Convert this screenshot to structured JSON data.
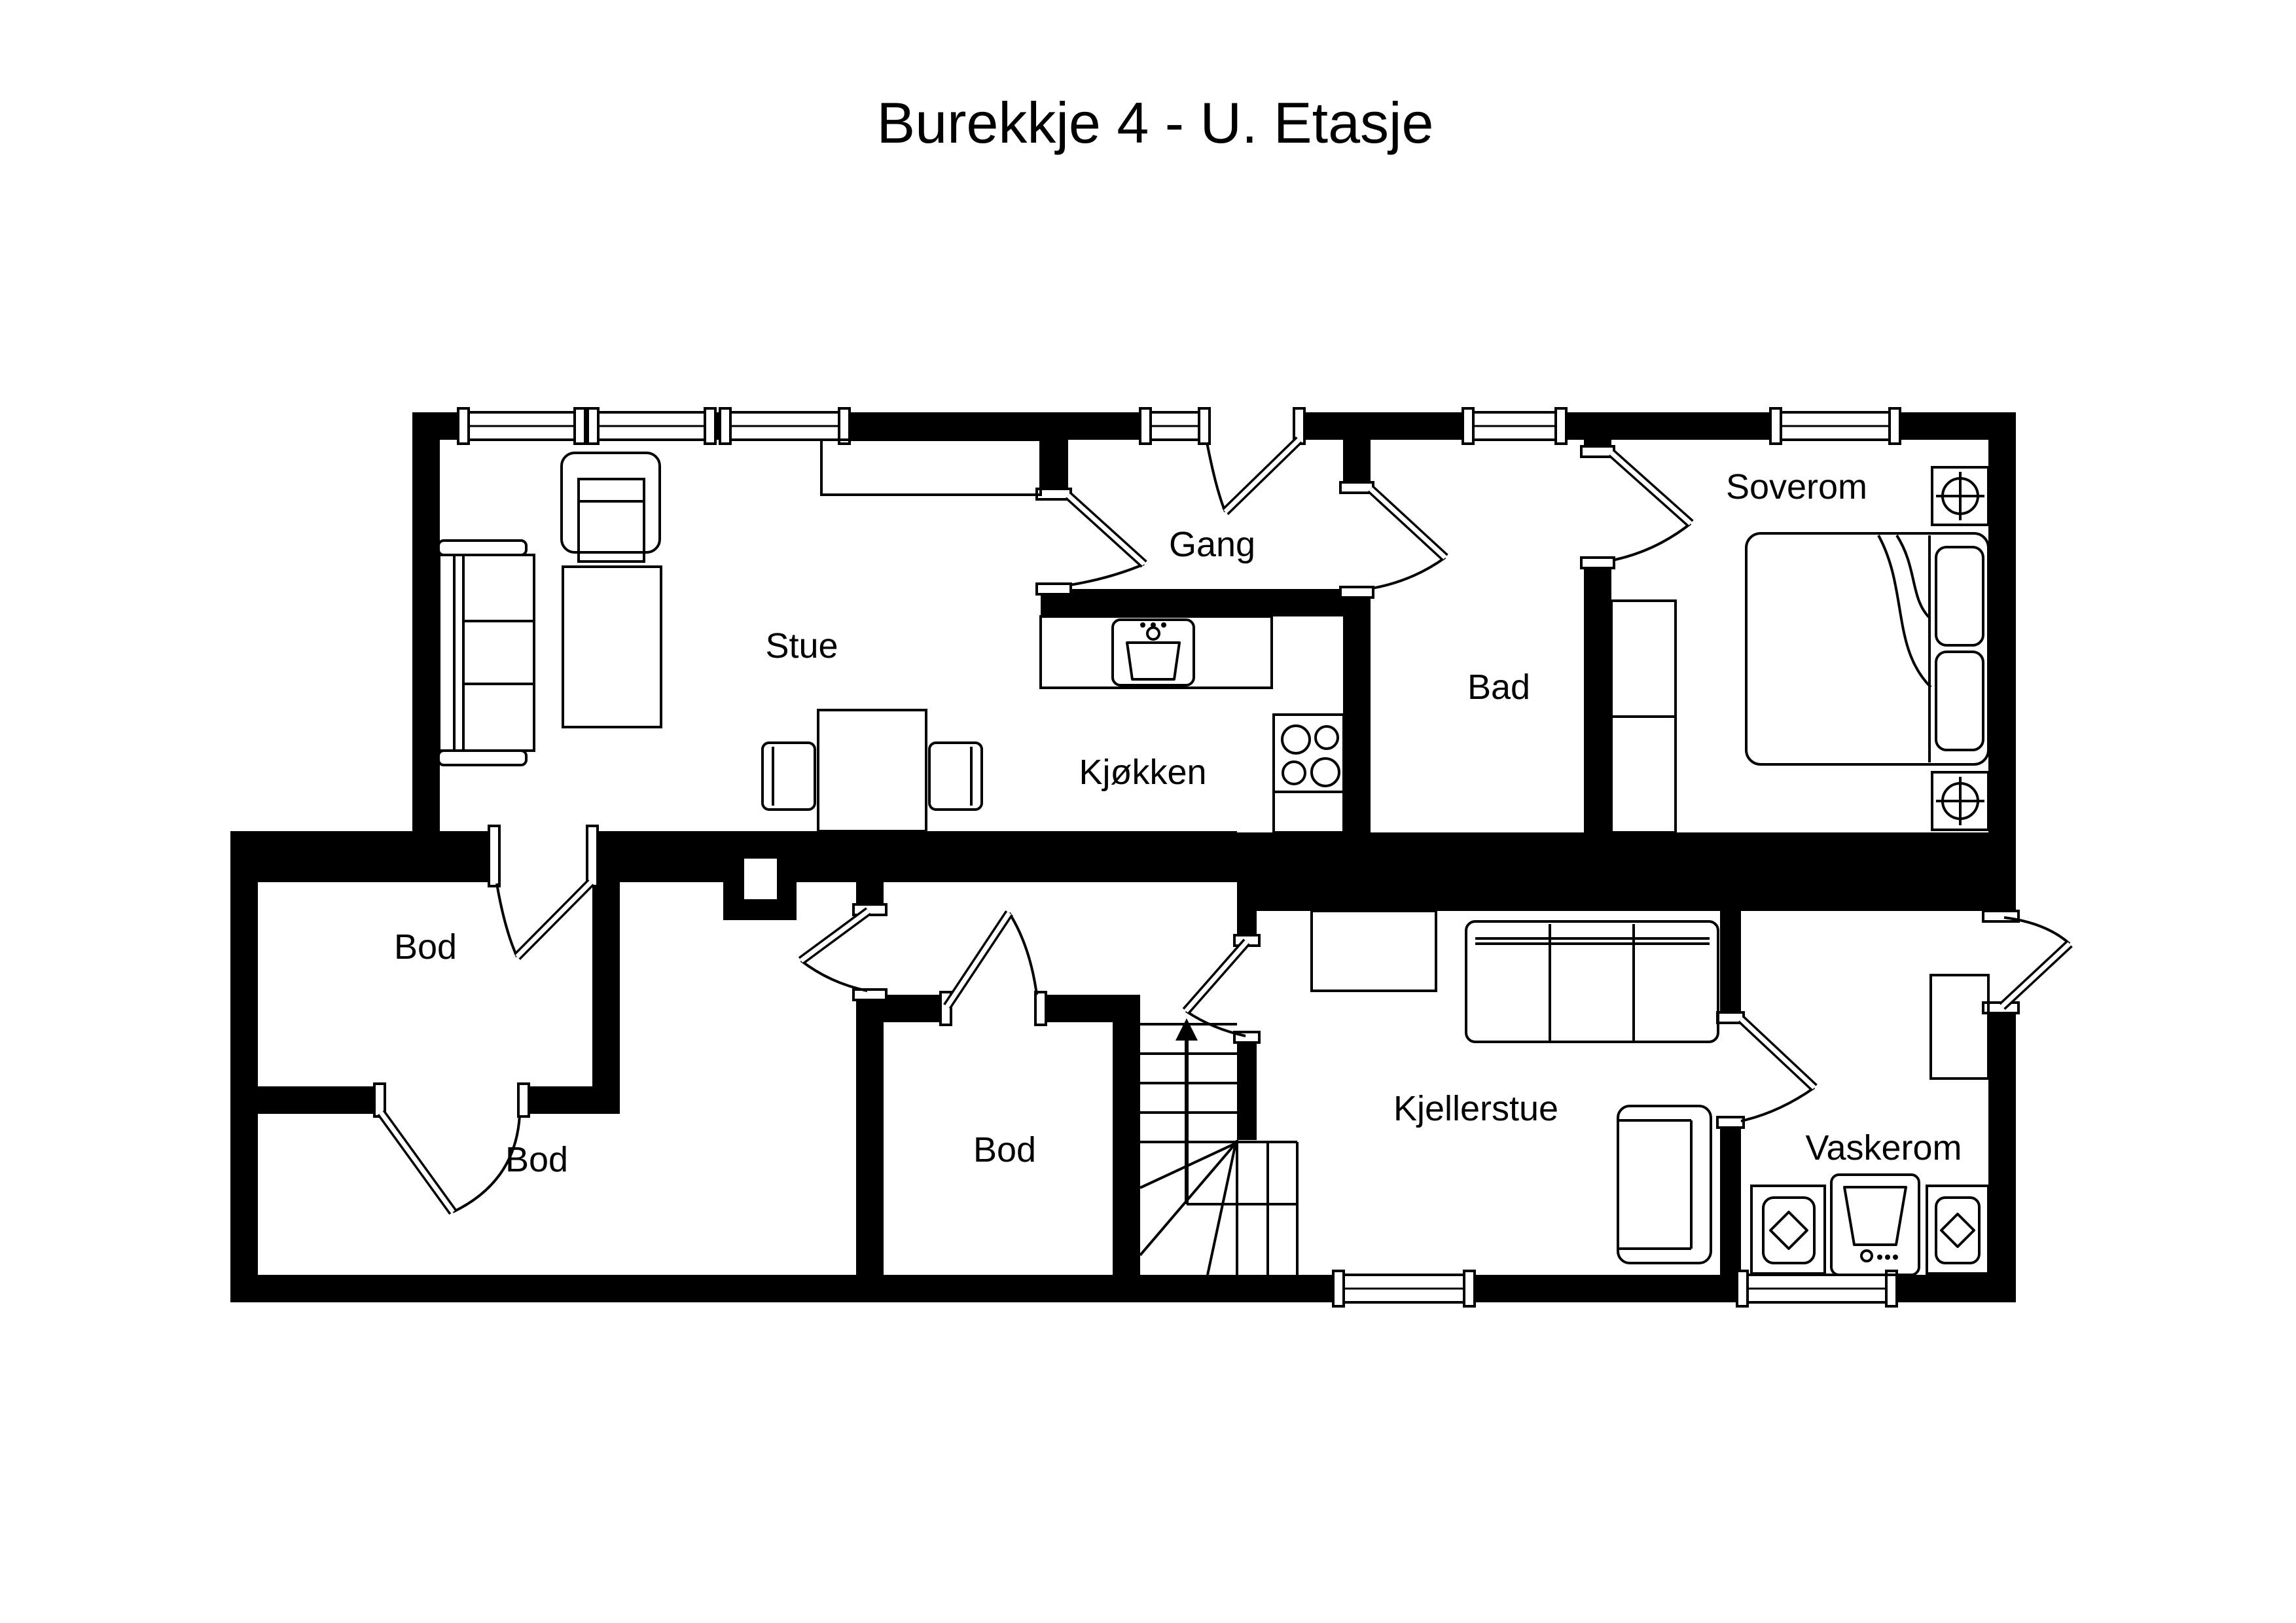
{
  "title": "Burekkje 4 - U. Etasje",
  "floor_plan": {
    "colors": {
      "walls": "#000000",
      "background": "#ffffff",
      "text": "#000000"
    },
    "rooms": [
      {
        "id": "stue",
        "label": "Stue"
      },
      {
        "id": "gang",
        "label": "Gang"
      },
      {
        "id": "kjokken",
        "label": "Kjøkken"
      },
      {
        "id": "bad",
        "label": "Bad"
      },
      {
        "id": "soverom",
        "label": "Soverom"
      },
      {
        "id": "bod-1",
        "label": "Bod"
      },
      {
        "id": "bod-2",
        "label": "Bod"
      },
      {
        "id": "bod-3",
        "label": "Bod"
      },
      {
        "id": "kjellerstue",
        "label": "Kjellerstue"
      },
      {
        "id": "vaskerom",
        "label": "Vaskerom"
      }
    ]
  }
}
